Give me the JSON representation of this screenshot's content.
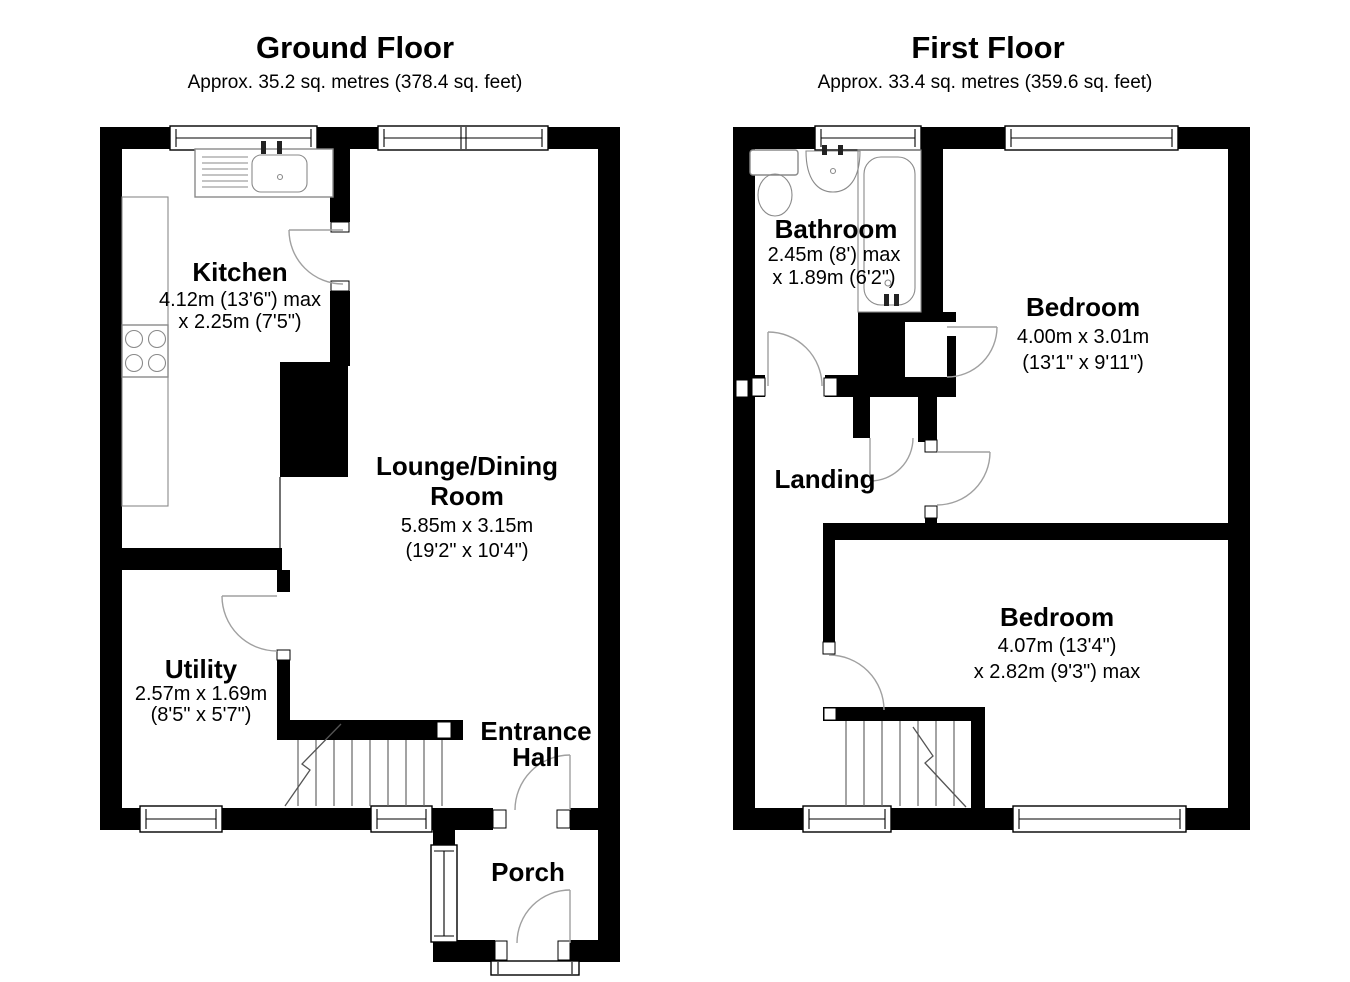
{
  "colors": {
    "wall": "#000000",
    "background": "#ffffff",
    "door_swing_line": "#a0a0a0",
    "fixture_line": "#8a8a8a",
    "text": "#000000"
  },
  "ground_floor": {
    "title": "Ground Floor",
    "subtitle": "Approx. 35.2 sq. metres (378.4 sq. feet)",
    "rooms": {
      "kitchen": {
        "name": "Kitchen",
        "dims": [
          "4.12m (13'6\") max",
          "x 2.25m (7'5\")"
        ]
      },
      "lounge_dining": {
        "name_line1": "Lounge/Dining",
        "name_line2": "Room",
        "dims": [
          "5.85m x 3.15m",
          "(19'2\" x 10'4\")"
        ]
      },
      "utility": {
        "name": "Utility",
        "dims": [
          "2.57m x 1.69m",
          "(8'5\" x 5'7\")"
        ]
      },
      "entrance_hall": {
        "name_line1": "Entrance",
        "name_line2": "Hall"
      },
      "porch": {
        "name": "Porch"
      }
    }
  },
  "first_floor": {
    "title": "First Floor",
    "subtitle": "Approx. 33.4 sq. metres (359.6 sq. feet)",
    "rooms": {
      "bathroom": {
        "name": "Bathroom",
        "dims": [
          "2.45m (8') max",
          "x 1.89m (6'2\")"
        ]
      },
      "bedroom_rear": {
        "name": "Bedroom",
        "dims": [
          "4.00m x 3.01m",
          "(13'1\" x 9'11\")"
        ]
      },
      "landing": {
        "name": "Landing"
      },
      "bedroom_front": {
        "name": "Bedroom",
        "dims": [
          "4.07m (13'4\")",
          "x 2.82m (9'3\") max"
        ]
      }
    }
  }
}
